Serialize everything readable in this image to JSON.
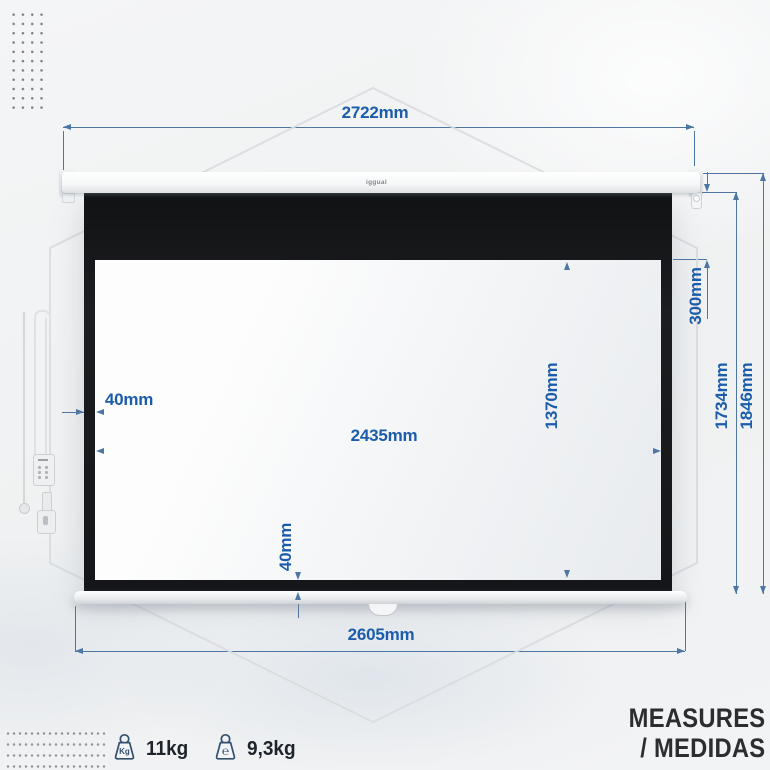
{
  "brand": {
    "logo": "iggual"
  },
  "heading": {
    "line1": "MEASURES",
    "line2": "/ MEDIDAS"
  },
  "dimensions": {
    "case_width": {
      "label": "2722mm"
    },
    "fabric_width": {
      "label": "2605mm"
    },
    "viewing_width": {
      "label": "2435mm"
    },
    "viewing_height": {
      "label": "1370mm"
    },
    "fabric_height": {
      "label": "1734mm"
    },
    "total_height": {
      "label": "1846mm"
    },
    "top_border": {
      "label": "300mm"
    },
    "left_border": {
      "label": "40mm"
    },
    "bottom_border": {
      "label": "40mm"
    }
  },
  "specs": [
    {
      "icon": "weight-kg-icon",
      "glyph": "Kg",
      "value": "11kg"
    },
    {
      "icon": "weight-estimated-icon",
      "glyph": "℮",
      "value": "9,3kg"
    }
  ],
  "colors": {
    "dimension_text": "#1b5cab",
    "dimension_line": "#4d76a3",
    "screen_border": "#17191b",
    "heading_text": "#2b2e30"
  }
}
